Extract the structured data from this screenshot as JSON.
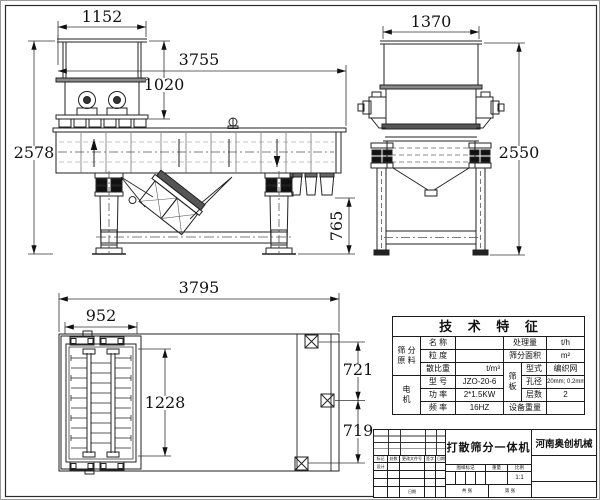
{
  "drawing": {
    "side_view": {
      "dim_top_width": "1152",
      "dim_total_length": "3755",
      "dim_hopper_height": "1020",
      "dim_total_height": "2578",
      "dim_discharge_height": "765"
    },
    "end_view": {
      "dim_top_width": "1370",
      "dim_total_height": "2550"
    },
    "plan_view": {
      "dim_total_length": "3795",
      "dim_breaker_width": "952",
      "dim_breaker_length": "1228",
      "dim_outlet_pitch_front": "721",
      "dim_outlet_pitch_rear": "719"
    }
  },
  "spec_table": {
    "title": "技 术 特 征",
    "material_group": "筛 分\n原 料",
    "motor_group": "电\n机",
    "screen_group": "筛\n板",
    "name_label": "名 称",
    "name_value": "",
    "capacity_label": "处理量",
    "capacity_unit": "t/h",
    "granularity_label": "粒 度",
    "granularity_value": "",
    "area_label": "筛分面积",
    "area_unit": "m²",
    "density_label": "散比重",
    "density_unit": "t/m³",
    "type_label": "型式",
    "type_value": "编织网",
    "model_label": "型 号",
    "model_value": "JZO-20-6",
    "aperture_label": "孔径",
    "aperture_value": "20mm; 0.2mm",
    "power_label": "功 率",
    "power_value": "2*1.5KW",
    "layers_label": "层数",
    "layers_value": "2",
    "frequency_label": "频 率",
    "frequency_value": "16HZ",
    "weight_label": "设备重量",
    "weight_value": ""
  },
  "title_block": {
    "drawing_title": "打散筛分一体机",
    "company": "河南奥创机械",
    "rev_headers": [
      "标记",
      "处数",
      "更改文件号",
      "签字",
      "日期"
    ],
    "design_label": "设计",
    "date_label": "日期",
    "mark_label": "图样标记",
    "weight_label": "重量",
    "scale_label": "比例",
    "scale_value": "1:1",
    "sheet_total": "共 张",
    "sheet_number": "第 张"
  }
}
